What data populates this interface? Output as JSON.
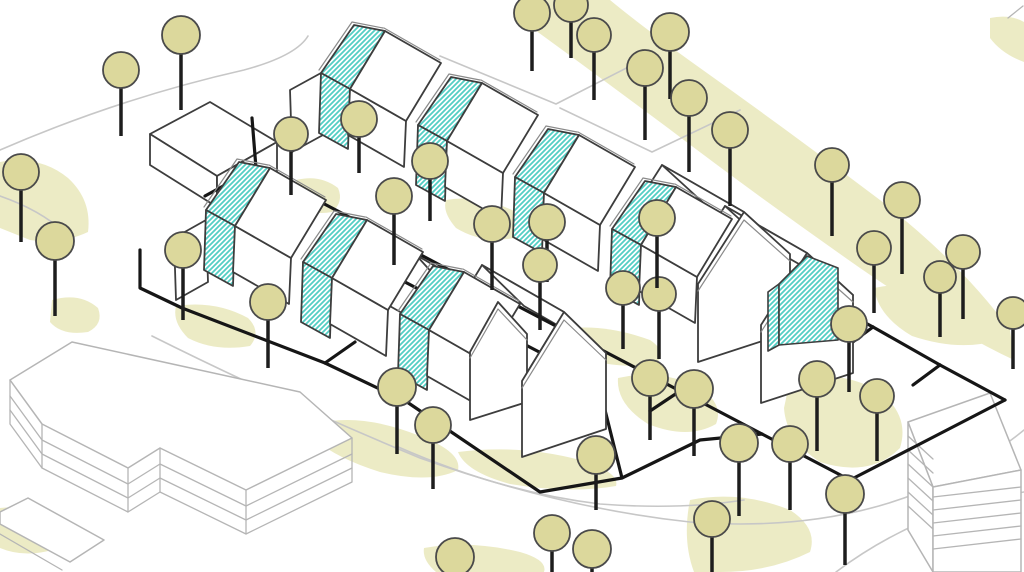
{
  "diagram": {
    "kind": "axonometric-site-plan",
    "width": 1024,
    "height": 572
  },
  "palette": {
    "bg": "#ffffff",
    "blob": "#ecebc5",
    "road": "#c7c7c7",
    "context": "#b5b5b5",
    "dark": "#3d3d3d",
    "trim": "#8a8a8a",
    "path": "#161616",
    "hatch": "#52cec4",
    "tree_fill": "#dcd89c",
    "tree_stroke": "#4a4a4a",
    "trunk": "#1d1d1d"
  },
  "hatch": {
    "size": 5,
    "line_width": 1.8
  },
  "blobs": [
    "M520,0 L610,0 Q640,25 700,68 Q790,132 880,200 Q960,262 1010,330 L1014,360 Q950,330 860,268 Q760,198 668,128 Q590,70 535,30 Q522,12 520,0 Z",
    "M0,162 Q40,155 68,178 Q92,200 88,232 Q60,245 30,240 L0,228 Z",
    "M52,300 Q80,292 98,308 Q104,324 88,332 Q62,336 50,322 Z",
    "M176,306 Q215,300 248,318 Q262,332 250,346 Q215,352 188,338 Q172,322 176,306 Z",
    "M296,180 Q320,174 338,188 Q344,202 332,212 Q310,216 298,204 Z",
    "M356,250 Q390,244 420,262 Q430,278 416,292 Q386,298 362,282 Q350,264 356,250 Z",
    "M446,200 Q480,194 516,212 Q528,226 514,238 Q482,244 456,228 Q442,212 446,200 Z",
    "M560,330 Q600,322 650,340 Q668,352 656,364 Q615,370 578,356 Q556,342 560,330 Z",
    "M316,424 Q360,412 420,436 Q462,452 458,470 Q430,484 380,472 Q336,458 316,440 Z",
    "M458,452 Q520,444 580,460 Q620,472 616,486 Q570,494 510,484 Q466,472 458,452 Z",
    "M618,378 Q660,368 700,388 Q724,404 716,424 Q688,440 648,424 Q616,404 618,378 Z",
    "M790,380 Q840,368 880,392 Q910,416 900,448 Q870,478 820,462 Q786,440 784,408 Z",
    "M874,288 Q920,278 970,300 Q1002,318 998,340 Q960,352 912,336 Q878,316 874,288 Z",
    "M690,500 Q740,490 790,510 Q818,528 810,552 Q770,572 720,572 L694,572 Q682,540 690,500 Z",
    "M424,548 Q470,540 520,552 Q548,560 544,572 L436,572 Q422,560 424,548 Z",
    "M0,508 Q30,504 52,520 Q64,536 52,550 Q24,558 0,548 Z",
    "M990,18 Q1010,14 1024,22 L1024,62 Q1002,54 990,38 Z"
  ],
  "roads": [
    "M152,336 Q280,400 420,458 Q560,508 690,522 Q820,532 920,492 Q980,466 1024,430",
    "M396,446 Q500,492 600,504 Q680,510 744,500",
    "M0,150 Q120,98 244,70 Q296,56 308,36",
    "M440,56 L556,104 L646,58",
    "M560,108 L652,152 L740,110",
    "M836,572 Q900,524 978,502 Q1012,494 1024,492",
    "M0,196 Q40,210 64,232"
  ],
  "context_filled": [
    "M10,380 L72,342 L300,392 L352,438 L246,490 L160,448 L128,468 L42,424 Z",
    "M28,498 L104,540 L70,562 L0,524 L0,512 Z",
    "M908,422 L990,393 L1021,470 L933,487 Z",
    "M908,422 L933,487 L933,572 L908,530 Z",
    "M933,487 L1021,470 L1021,572 L933,572 Z"
  ],
  "context_lines": [
    "M10,380 L10,424 L42,468 L42,424",
    "M42,468 L128,512 L128,468",
    "M128,512 L160,492 L160,448",
    "M160,492 L246,534 L246,490",
    "M246,534 L352,482 L352,438",
    "M10,396 L42,440 L128,484 L160,464 L246,506 L352,454",
    "M10,410 L42,454 L128,498 L160,478 L246,520 L352,468",
    "M0,534 L62,570",
    "M908,436 L933,459",
    "M908,450 L933,473",
    "M908,464 L933,487",
    "M908,478 L933,501",
    "M908,492 L933,515",
    "M908,506 L933,529",
    "M933,497 L1021,487",
    "M933,510 L1021,500",
    "M933,523 L1021,513",
    "M933,536 L1021,526",
    "M933,549 L1021,539",
    "M1008,18 L1023,6"
  ],
  "detached_house": [
    "M150,134 L210,102 L277,142 L217,176 Z",
    "M150,134 L217,176 L217,207 L150,165 Z",
    "M217,176 L277,142 L277,171 L217,207 Z"
  ],
  "end_house_roofs": [
    "M290,90 L321,73 L323,135 L292,152 Z",
    "M174,238 L206,220 L208,282 L176,300 Z",
    "M698,284 L744,212 L662,165 L616,237 Z",
    "M744,212 L790,254 L708,207 L662,165 Z",
    "M761,325 L807,253 L725,206 L679,278 Z",
    "M807,253 L853,295 L771,248 L725,206 Z",
    "M470,352 L498,302 L416,255 L388,305 Z",
    "M498,302 L527,334 L445,287 L416,255 Z",
    "M522,381 L564,312 L482,265 L440,334 Z",
    "M564,312 L606,353 L524,306 L482,265 Z"
  ],
  "path_network": [
    "M252,118 L256,168 L370,228 L470,281 L575,336 L680,391 L762,434",
    "M370,228 L340,248 L445,303 L545,355 L598,382",
    "M470,281 L440,301",
    "M575,336 L545,356",
    "M680,391 L650,411",
    "M140,250 L140,288 L182,308 L325,363 L407,402 L540,492 L622,478 L700,440 L762,434",
    "M800,288 L873,327 L940,365 L1005,400",
    "M762,434 L850,480 L916,446 L1005,400",
    "M873,327 L846,347",
    "M940,365 L913,385",
    "M256,168 L205,196",
    "M325,363 L355,342",
    "M598,382 L622,478"
  ],
  "rows": [
    {
      "origin": [
        321,
        73
      ],
      "count": 4,
      "pitch": [
        97,
        52
      ]
    },
    {
      "origin": [
        206,
        210
      ],
      "count": 3,
      "pitch": [
        97,
        52
      ]
    }
  ],
  "module_template": {
    "slab_roof": [
      [
        0,
        0
      ],
      [
        33,
        -48
      ],
      [
        64,
        -42
      ],
      [
        29,
        16
      ]
    ],
    "slab_wall": [
      [
        0,
        0
      ],
      [
        29,
        16
      ],
      [
        27,
        76
      ],
      [
        -2,
        60
      ]
    ],
    "slab_trim": [
      [
        -2,
        -3
      ],
      [
        31,
        -51
      ],
      [
        62,
        -45
      ]
    ],
    "house_wall": [
      [
        29,
        16
      ],
      [
        85,
        48
      ],
      [
        83,
        94
      ],
      [
        27,
        62
      ]
    ],
    "house_roof": [
      [
        29,
        16
      ],
      [
        64,
        -42
      ],
      [
        120,
        -10
      ],
      [
        85,
        48
      ]
    ],
    "house_trim": [
      [
        63,
        -45
      ],
      [
        119,
        -13
      ]
    ]
  },
  "module_parts": [
    {
      "key": "slab_roof",
      "fill": "hatch",
      "stroke": "dark",
      "w": 1.8,
      "open": false
    },
    {
      "key": "slab_wall",
      "fill": "hatch",
      "stroke": "dark",
      "w": 1.8,
      "open": false
    },
    {
      "key": "slab_trim",
      "fill": "none",
      "stroke": "trim",
      "w": 1.2,
      "open": true
    },
    {
      "key": "house_wall",
      "fill": "#ffffff",
      "stroke": "dark",
      "w": 1.8,
      "open": false
    },
    {
      "key": "house_roof",
      "fill": "#ffffff",
      "stroke": "dark",
      "w": 1.8,
      "open": false
    },
    {
      "key": "house_trim",
      "fill": "none",
      "stroke": "trim",
      "w": 1.2,
      "open": true
    }
  ],
  "end_house_fronts": [
    "M698,362 L698,284 L744,212 L790,254 L790,332 Z",
    "M761,403 L761,325 L807,253 L853,295 L853,373 Z",
    "M470,420 L470,352 L498,302 L527,334 L527,402 Z",
    "M522,457 L522,381 L564,312 L606,353 L606,429 Z"
  ],
  "end_house_trims": [
    "M698,291 L744,220 L790,261",
    "M761,332 L807,261 L853,302",
    "M470,358 L498,309 L527,340",
    "M522,388 L564,320 L606,360"
  ],
  "porch_hatch": [
    "M768,292 L779,284 L779,345 L768,351 Z",
    "M779,345 L779,284 L807,256 L838,268 L838,340 Z"
  ],
  "trees": [
    [
      181,
      35,
      19,
      60
    ],
    [
      121,
      70,
      18,
      52
    ],
    [
      21,
      172,
      18,
      56
    ],
    [
      55,
      241,
      19,
      60
    ],
    [
      183,
      250,
      18,
      56
    ],
    [
      291,
      134,
      17,
      48
    ],
    [
      359,
      119,
      18,
      40
    ],
    [
      430,
      161,
      18,
      46
    ],
    [
      492,
      224,
      18,
      52
    ],
    [
      547,
      222,
      18,
      46
    ],
    [
      540,
      265,
      17,
      52
    ],
    [
      394,
      196,
      18,
      55
    ],
    [
      268,
      302,
      18,
      52
    ],
    [
      397,
      387,
      19,
      52
    ],
    [
      433,
      425,
      18,
      50
    ],
    [
      623,
      288,
      17,
      48
    ],
    [
      659,
      294,
      17,
      52
    ],
    [
      657,
      218,
      18,
      56
    ],
    [
      532,
      13,
      18,
      44
    ],
    [
      571,
      5,
      17,
      40
    ],
    [
      594,
      35,
      17,
      52
    ],
    [
      645,
      68,
      18,
      58
    ],
    [
      670,
      32,
      19,
      52
    ],
    [
      689,
      98,
      18,
      60
    ],
    [
      730,
      130,
      18,
      62
    ],
    [
      832,
      165,
      17,
      58
    ],
    [
      874,
      248,
      17,
      52
    ],
    [
      902,
      200,
      18,
      60
    ],
    [
      963,
      252,
      17,
      54
    ],
    [
      940,
      277,
      16,
      48
    ],
    [
      1013,
      313,
      16,
      44
    ],
    [
      849,
      324,
      18,
      54
    ],
    [
      817,
      379,
      18,
      58
    ],
    [
      877,
      396,
      17,
      52
    ],
    [
      650,
      378,
      18,
      48
    ],
    [
      694,
      389,
      19,
      52
    ],
    [
      739,
      443,
      19,
      58
    ],
    [
      790,
      444,
      18,
      52
    ],
    [
      845,
      494,
      19,
      56
    ],
    [
      596,
      455,
      19,
      40
    ],
    [
      592,
      549,
      19,
      22
    ],
    [
      712,
      519,
      18,
      50
    ],
    [
      552,
      533,
      18,
      38
    ],
    [
      455,
      557,
      19,
      14
    ]
  ],
  "render_order": [
    {
      "name": "landscape-blobs",
      "kind": "paths",
      "src": "blobs",
      "item": "landscape-blob",
      "fill": "blob",
      "stroke": "none",
      "w": 0
    },
    {
      "name": "roads",
      "kind": "paths",
      "src": "roads",
      "item": "road-line",
      "fill": "none",
      "stroke": "road",
      "w": 1.6
    },
    {
      "name": "context-buildings",
      "kind": "paths",
      "src": "context_filled",
      "item": "context-building-face",
      "fill": "#ffffff",
      "stroke": "context",
      "w": 1.5
    },
    {
      "name": "context-lines",
      "kind": "paths",
      "src": "context_lines",
      "item": "context-building-edge",
      "fill": "none",
      "stroke": "context",
      "w": 1.3
    },
    {
      "name": "detached-house",
      "kind": "paths",
      "src": "detached_house",
      "item": "detached-house-face",
      "fill": "#ffffff",
      "stroke": "dark",
      "w": 1.8
    },
    {
      "name": "end-house-roofs",
      "kind": "paths",
      "src": "end_house_roofs",
      "item": "end-house-roof",
      "fill": "#ffffff",
      "stroke": "dark",
      "w": 1.8
    },
    {
      "name": "path-network",
      "kind": "paths",
      "src": "path_network",
      "item": "footpath-line",
      "fill": "none",
      "stroke": "path",
      "w": 3.2
    },
    {
      "name": "housing-rows",
      "kind": "modules"
    },
    {
      "name": "end-house-fronts",
      "kind": "paths",
      "src": "end_house_fronts",
      "item": "end-house-gable",
      "fill": "#ffffff",
      "stroke": "dark",
      "w": 1.8
    },
    {
      "name": "end-house-trims",
      "kind": "paths",
      "src": "end_house_trims",
      "item": "gable-trim-line",
      "fill": "none",
      "stroke": "trim",
      "w": 1.2
    },
    {
      "name": "porch",
      "kind": "paths",
      "src": "porch_hatch",
      "item": "hatched-porch-face",
      "fill": "hatch",
      "stroke": "dark",
      "w": 1.6
    },
    {
      "name": "trees",
      "kind": "trees"
    }
  ]
}
